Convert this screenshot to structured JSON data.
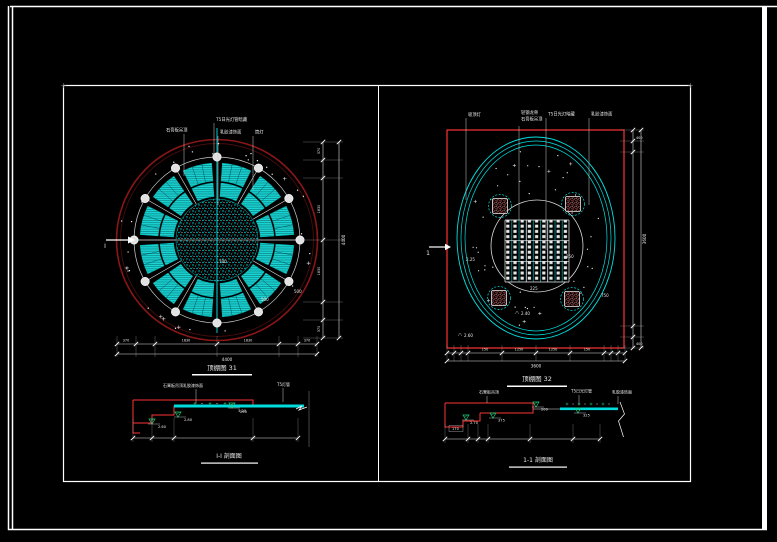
{
  "colors": {
    "background": "#000000",
    "frame": "#ffffff",
    "red": "#ff3333",
    "dark_red": "#8a1616",
    "cyan": "#00e0e0",
    "green": "#1fcf7a",
    "pink": "#e87e7e"
  },
  "left": {
    "caption": "顶棚图 31",
    "section_caption": "I-I 剖面图",
    "cut_label": "I",
    "leaders": {
      "top": "T5日光灯管暗藏",
      "left": "石膏板吊顶",
      "mid": "乳胶漆饰面",
      "right": "筒灯"
    },
    "radius_labels": {
      "a": "700",
      "b": "500",
      "c": "500"
    },
    "dims": {
      "b1": "370",
      "b2": "1830",
      "b3": "1830",
      "b4": "370",
      "total_bottom": "4400",
      "r1": "370",
      "r2": "1830",
      "r3": "1830",
      "r4": "370",
      "total_right": "4400"
    },
    "section": {
      "leader_left": "石膏板吊顶乳胶漆饰面",
      "leader_right": "T5灯管",
      "elev1": "2.60",
      "elev2": "2.80",
      "elev3": "3.20",
      "dim1": "250"
    }
  },
  "right": {
    "caption": "顶棚图 32",
    "section_caption": "1-1 剖面图",
    "cut_label": "1",
    "leaders": {
      "l1": "吸顶灯",
      "l2a": "轻钢龙骨",
      "l2b": "石膏板吊顶",
      "l3": "T5日光灯暗藏",
      "l4": "乳胶漆饰面"
    },
    "inner_labels": {
      "a": "2.25",
      "b": "250",
      "c": "225",
      "d": "2.40",
      "e": "2.60",
      "f": "750"
    },
    "dims": {
      "b1": "150",
      "b2": "1250",
      "b3": "1250",
      "b4": "150",
      "total_bottom": "3600",
      "rt": "400",
      "rb": "400",
      "total_right": "3600"
    },
    "section": {
      "leader1": "石膏板吊顶",
      "leader2": "T5日光灯管",
      "leader3": "乳胶漆饰面",
      "d1": "200",
      "d2": "375",
      "d3": "325",
      "d4": "170",
      "elev": "2.70"
    }
  }
}
